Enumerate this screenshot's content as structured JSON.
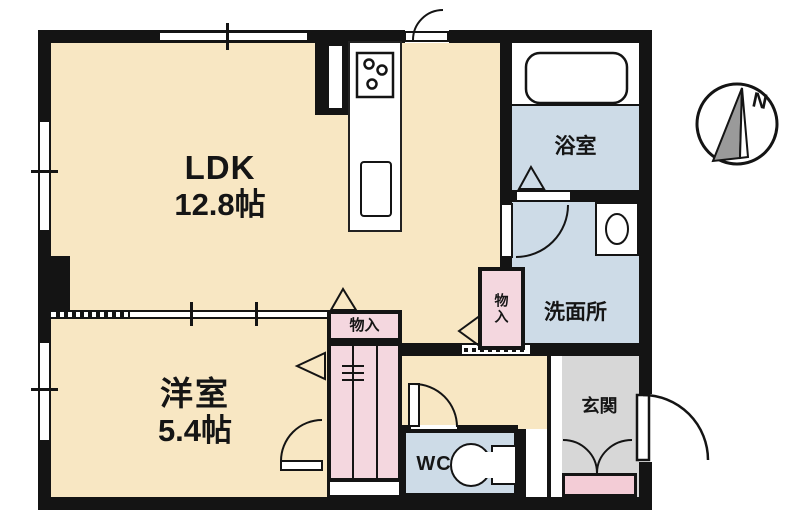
{
  "rooms": {
    "ldk": {
      "label": "LDK",
      "area": "12.8帖"
    },
    "western_room": {
      "label": "洋室",
      "area": "5.4帖"
    },
    "bathroom": {
      "label": "浴室"
    },
    "washroom": {
      "label": "洗面所"
    },
    "toilet": {
      "label": "WC"
    },
    "entrance": {
      "label": "玄関"
    },
    "storage_hall": {
      "label": "物入"
    },
    "storage_bedroom": {
      "label": "物入"
    }
  },
  "compass": {
    "north_label": "N"
  },
  "colors": {
    "room_cream": "#f8e7c3",
    "wet_blue": "#cddbe7",
    "closet_pink": "#f4d7df",
    "shoe_pink": "#f3ccd6",
    "entrance_gray": "#d7d7d7",
    "wall_black": "#141414"
  }
}
